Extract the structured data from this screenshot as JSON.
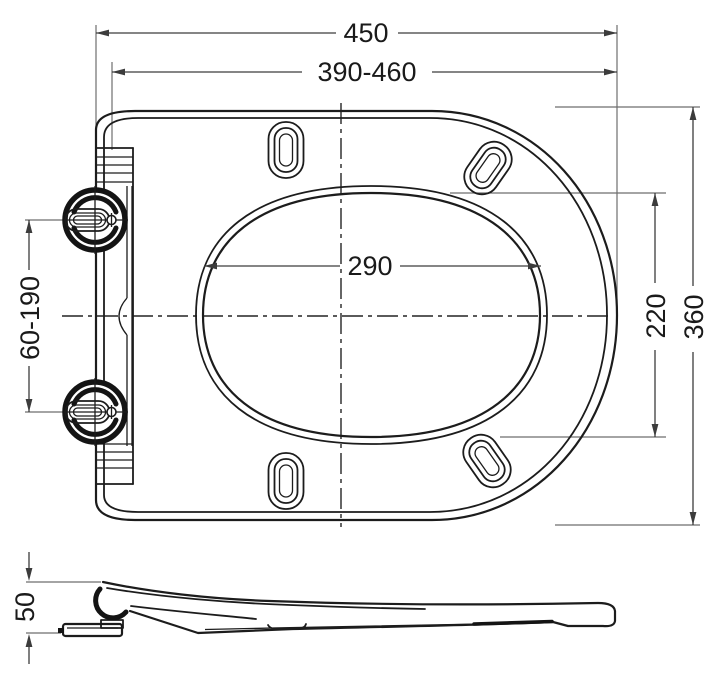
{
  "drawing": {
    "background": "#ffffff",
    "outline_color": "#1c1c1c",
    "dimension_line_color": "#3c3c3c",
    "extension_line_color": "#6e6e6e",
    "dimensions": {
      "overall_length": "450",
      "adjustable_mounting_length": "390-460",
      "opening_width": "290",
      "opening_length": "220",
      "overall_width": "360",
      "hinge_spacing_range": "60-190",
      "profile_height": "50"
    }
  }
}
